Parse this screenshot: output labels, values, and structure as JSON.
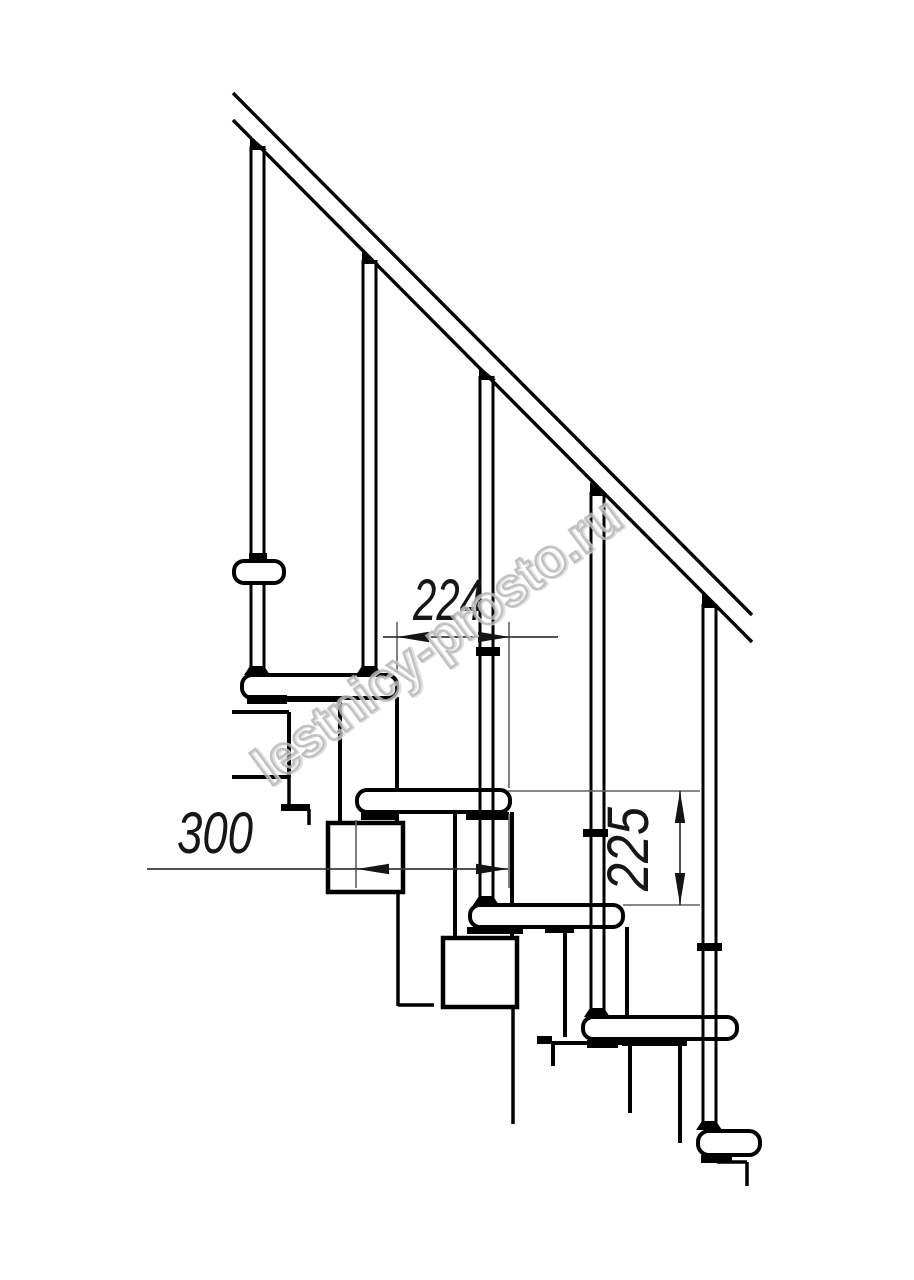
{
  "page": {
    "kind": "technical-drawing",
    "subject": "modular staircase side elevation fragment",
    "background": "#ffffff"
  },
  "watermark": {
    "text": "lestnicy-prosto.ru",
    "cx": 448,
    "cy": 656,
    "rotation": -36.5,
    "font_size": 55,
    "text_length": 442,
    "stroke_light": "#dcdcdc",
    "stroke_dark": "#b7b7b7",
    "opacity": 0.85
  },
  "dimensions": {
    "run_between_steps": {
      "label": "224",
      "orientation": "horizontal"
    },
    "tread_depth": {
      "label": "300",
      "orientation": "horizontal"
    },
    "riser_height": {
      "label": "225",
      "orientation": "vertical"
    }
  },
  "drawing": {
    "canvas": {
      "w": 914,
      "h": 1280,
      "bg": "#ffffff"
    },
    "styles": {
      "ink": "#000000",
      "thin_line": "#606060",
      "dim_line": "#3a3a3a",
      "arrow": "#141414",
      "dim_text": "#161616"
    },
    "handrail": {
      "stroke": 3.4,
      "lines": [
        [
          233,
          93,
          752,
          615
        ],
        [
          233,
          120,
          752,
          642
        ]
      ]
    },
    "balusters": [
      {
        "x1": 251,
        "x2": 264,
        "top": 146,
        "bottom": 675
      },
      {
        "x1": 363,
        "x2": 376,
        "top": 260,
        "bottom": 675
      },
      {
        "x1": 480,
        "x2": 493,
        "top": 376,
        "bottom": 905
      },
      {
        "x1": 591,
        "x2": 604,
        "top": 492,
        "bottom": 1017
      },
      {
        "x1": 703,
        "x2": 716,
        "top": 604,
        "bottom": 1130
      }
    ],
    "baluster_stroke": 3,
    "rail_wedges": [
      [
        [
          250,
          150
        ],
        [
          250,
          136
        ],
        [
          267,
          150
        ]
      ],
      [
        [
          362,
          264
        ],
        [
          362,
          250
        ],
        [
          379,
          264
        ]
      ],
      [
        [
          479,
          380
        ],
        [
          479,
          366
        ],
        [
          496,
          380
        ]
      ],
      [
        [
          590,
          496
        ],
        [
          590,
          482
        ],
        [
          607,
          496
        ]
      ],
      [
        [
          702,
          608
        ],
        [
          702,
          594
        ],
        [
          719,
          608
        ]
      ]
    ],
    "feet": [
      {
        "cx": 257,
        "base": 675
      },
      {
        "cx": 369,
        "base": 675
      },
      {
        "cx": 486,
        "base": 905
      },
      {
        "cx": 597,
        "base": 1017
      },
      {
        "cx": 709,
        "base": 1130
      }
    ],
    "collar": {
      "x": 234,
      "y": 561,
      "w": 50,
      "h": 22,
      "r": 10,
      "stroke": 4
    },
    "treads": [
      {
        "x": 242,
        "y": 675,
        "w": 155,
        "h": 23,
        "r": 10
      },
      {
        "x": 357,
        "y": 790,
        "w": 153,
        "h": 22,
        "r": 10
      },
      {
        "x": 470,
        "y": 905,
        "w": 153,
        "h": 22,
        "r": 10
      },
      {
        "x": 583,
        "y": 1017,
        "w": 154,
        "h": 22,
        "r": 10
      },
      {
        "x": 698,
        "y": 1131,
        "w": 62,
        "h": 24,
        "r": 11
      }
    ],
    "tread_stroke": 4,
    "spine_lines": [
      [
        340,
        697,
        340,
        823,
        4
      ],
      [
        397,
        697,
        397,
        823,
        4
      ],
      [
        455,
        812,
        455,
        938,
        4
      ],
      [
        512,
        812,
        512,
        938,
        4
      ],
      [
        565,
        927,
        565,
        1037,
        4
      ],
      [
        627,
        927,
        627,
        1017,
        4
      ],
      [
        680,
        1040,
        680,
        1143,
        4
      ],
      [
        232,
        712,
        289,
        712,
        4
      ],
      [
        289,
        712,
        289,
        777,
        4
      ],
      [
        232,
        777,
        289,
        777,
        4
      ],
      [
        289,
        777,
        289,
        805,
        3.5
      ],
      [
        309,
        809,
        309,
        825,
        3.5
      ],
      [
        398,
        892,
        398,
        1006,
        3.5
      ],
      [
        398,
        1005,
        434,
        1005,
        3.5
      ],
      [
        513,
        1007,
        513,
        1124,
        3.5
      ],
      [
        551,
        1043,
        630,
        1043,
        4
      ],
      [
        553,
        1043,
        553,
        1066,
        4
      ],
      [
        630,
        1043,
        630,
        1113,
        4
      ],
      [
        717,
        1162,
        747,
        1162,
        3.5
      ],
      [
        747,
        1162,
        747,
        1186,
        3.5
      ]
    ],
    "boxes": [
      {
        "x": 328,
        "y": 823,
        "w": 75,
        "h": 69,
        "stroke": 4.5
      },
      {
        "x": 443,
        "y": 938,
        "w": 74,
        "h": 69,
        "stroke": 4.5
      }
    ],
    "black_rects": [
      [
        247,
        695,
        40,
        9
      ],
      [
        287,
        696,
        54,
        6
      ],
      [
        361,
        812,
        34,
        8
      ],
      [
        466,
        812,
        43,
        8
      ],
      [
        467,
        927,
        56,
        7
      ],
      [
        545,
        927,
        29,
        6
      ],
      [
        587,
        1040,
        31,
        8
      ],
      [
        622,
        1040,
        65,
        6
      ],
      [
        701,
        1155,
        31,
        8
      ],
      [
        281,
        804,
        29,
        7
      ],
      [
        537,
        1036,
        15,
        8
      ],
      [
        249,
        553,
        18,
        9
      ],
      [
        476,
        647,
        24,
        9
      ],
      [
        583,
        829,
        25,
        8
      ],
      [
        697,
        943,
        25,
        8
      ]
    ],
    "dims": {
      "ext_lines": [
        [
          397,
          622,
          397,
          672
        ],
        [
          509,
          622,
          509,
          788
        ],
        [
          509,
          814,
          509,
          888
        ],
        [
          356,
          820,
          356,
          888
        ],
        [
          508,
          791,
          700,
          791
        ],
        [
          623,
          905,
          700,
          905
        ]
      ],
      "dim_lines": [
        [
          383,
          637,
          558,
          637
        ],
        [
          147,
          869,
          508,
          869
        ],
        [
          680,
          791,
          680,
          905
        ]
      ],
      "arrows": [
        [
          397,
          637,
          "left"
        ],
        [
          510,
          637,
          "right"
        ],
        [
          357,
          869,
          "left"
        ],
        [
          508,
          869,
          "right"
        ],
        [
          680,
          791,
          "up"
        ],
        [
          680,
          905,
          "down"
        ]
      ],
      "labels": [
        {
          "bind": "dimensions.run_between_steps.label",
          "x": 448,
          "y": 620,
          "rot": 0,
          "size": 58,
          "tl": 70
        },
        {
          "bind": "dimensions.tread_depth.label",
          "x": 215,
          "y": 853,
          "rot": 0,
          "size": 58,
          "tl": 76
        },
        {
          "bind": "dimensions.riser_height.label",
          "x": 648,
          "y": 849,
          "rot": -90,
          "size": 58,
          "tl": 84
        }
      ]
    }
  }
}
